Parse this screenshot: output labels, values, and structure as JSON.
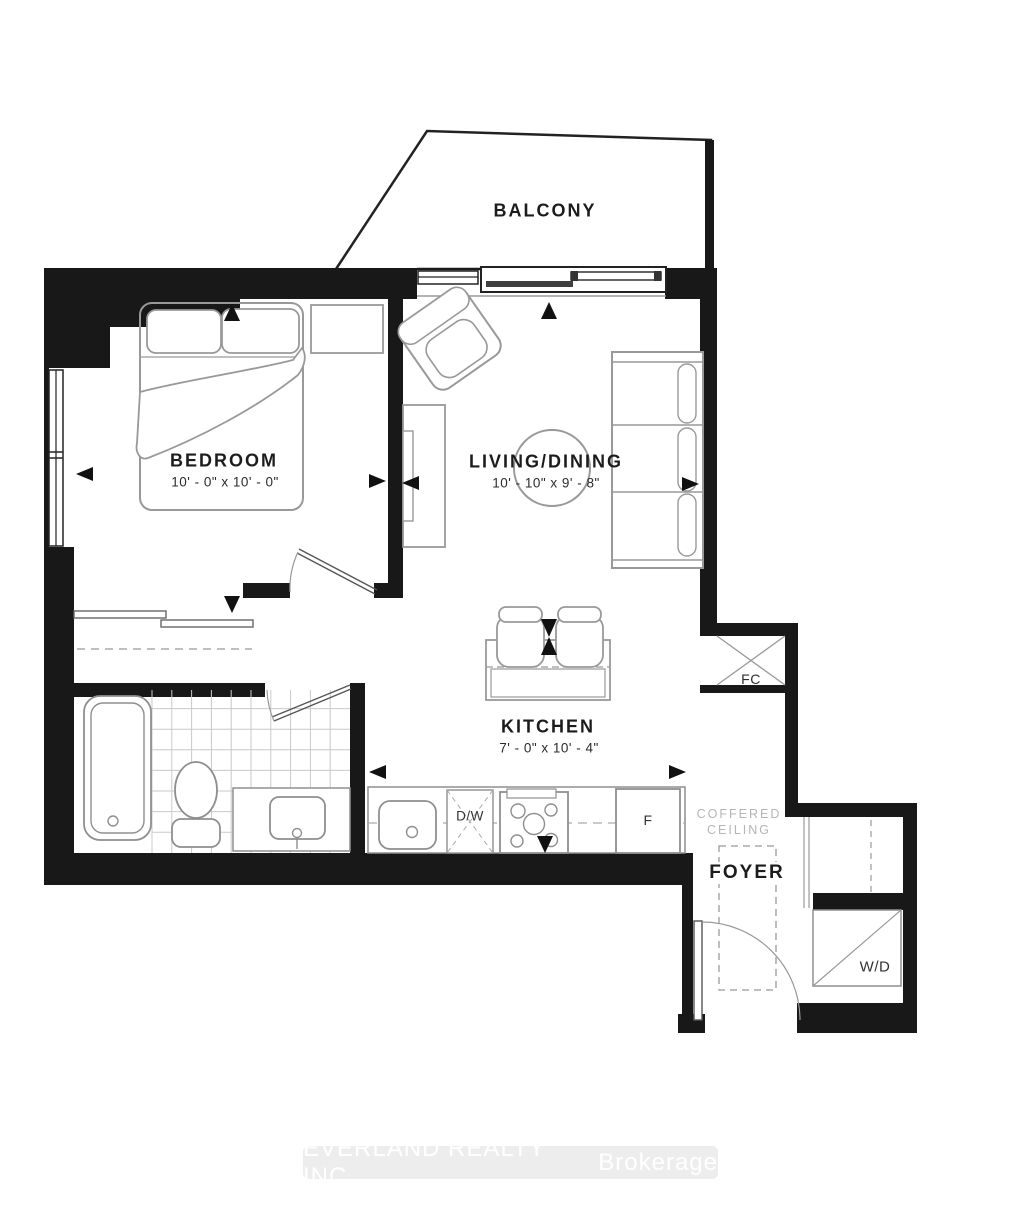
{
  "floorplan": {
    "balcony": {
      "label": "BALCONY"
    },
    "bedroom": {
      "label": "BEDROOM",
      "dimensions": "10' - 0\" x 10' - 0\""
    },
    "living_dining": {
      "label": "LIVING/DINING",
      "dimensions": "10' - 10\" x 9' - 8\""
    },
    "kitchen": {
      "label": "KITCHEN",
      "dimensions": "7' - 0\" x 10' - 4\""
    },
    "foyer": {
      "label": "FOYER"
    },
    "coffered_ceiling": {
      "line1": "COFFERED",
      "line2": "CEILING"
    },
    "closets": {
      "foyer_closet": "FC",
      "washer_dryer": "W/D"
    },
    "appliances": {
      "dishwasher": "D/W",
      "fridge": "F"
    },
    "watermark": {
      "company": "EVERLAND REALTY INC.",
      "suffix": "Brokerage"
    }
  },
  "colors": {
    "wall": "#181818",
    "furniture_line": "#999999",
    "label_text": "#1c1c1c",
    "muted_text": "#b5b5b5",
    "watermark_bg": "#ededed",
    "watermark_text": "#ffffff"
  }
}
